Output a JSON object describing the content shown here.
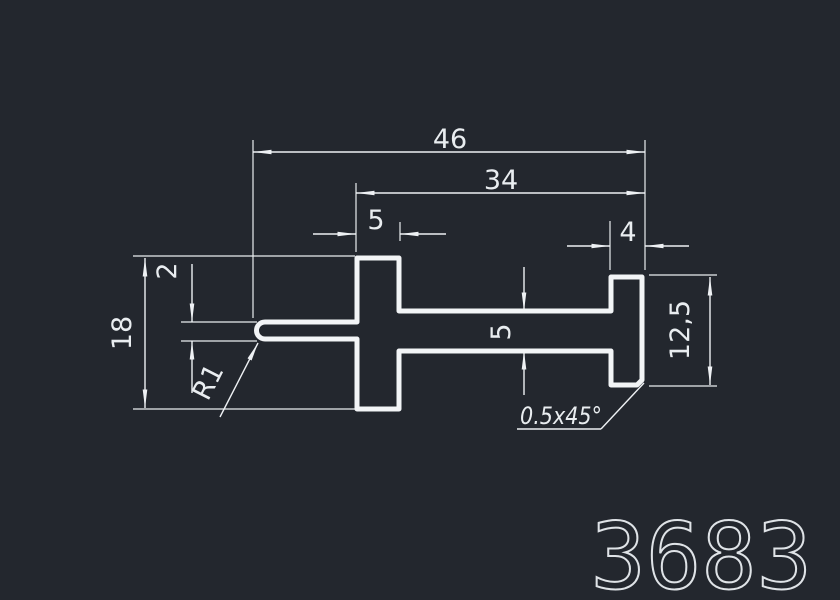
{
  "colors": {
    "background": "#23272e",
    "lines": "#eef1f4",
    "text": "#e9edf0"
  },
  "part_number": "3683",
  "dims": {
    "overall_width": "46",
    "upper_width": "34",
    "left_flange_width": "5",
    "right_flange_width": "4",
    "left_height": "18",
    "slot_thickness": "2",
    "web_thickness": "5",
    "right_height": "12,5",
    "corner_radius": "R1",
    "chamfer": "0.5x45°"
  }
}
